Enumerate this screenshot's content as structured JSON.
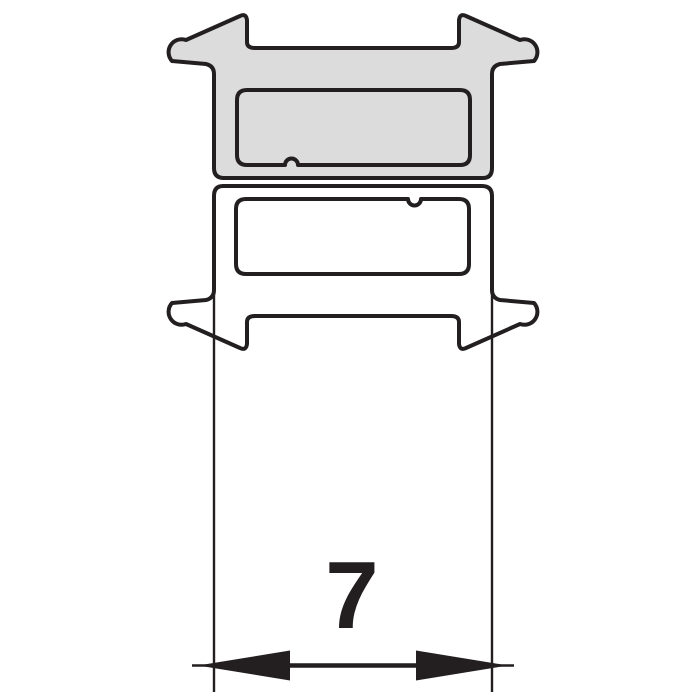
{
  "diagram": {
    "kind": "technical-profile-cross-section",
    "dimension": {
      "label": "7"
    },
    "colors": {
      "outline": "#231f20",
      "upper_profile_fill": "#dcdcdc",
      "lower_profile_fill": "#ffffff",
      "background": "#ffffff"
    }
  }
}
